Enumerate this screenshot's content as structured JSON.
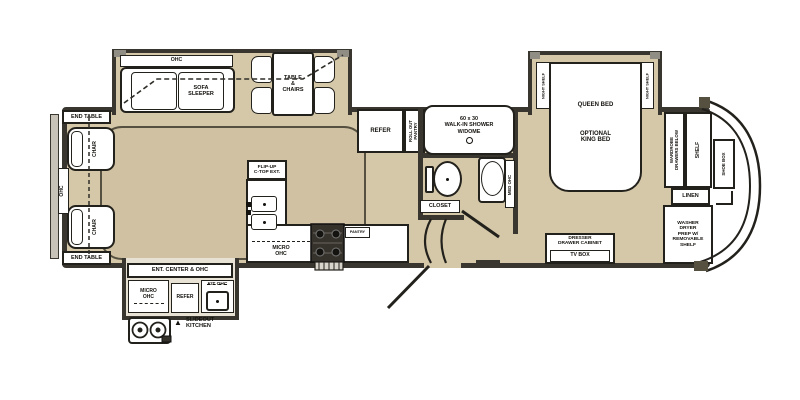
{
  "title": "fifth-wheel-rv-floor-plan",
  "colors": {
    "wall": "#39362f",
    "floor_tan": "#d5c8a9",
    "living_floor": "#cfc1a2",
    "fixture_white": "#ffffff",
    "slideout_fill": "#e7e2d4",
    "gray_cap": "#908d84"
  },
  "rear": {
    "end_table_top": "END TABLE",
    "end_table_bottom": "END TABLE",
    "chair_top": "CHAIR",
    "chair_bottom": "CHAIR",
    "ohc": "OHC"
  },
  "living_slideout": {
    "ohc": "OHC",
    "sofa_sleeper": "SOFA\nSLEEPER",
    "table_chairs": "TABLE\n&\nCHAIRS"
  },
  "kitchen": {
    "flip_up": "FLIP-UP\nC-TOP EXT.",
    "micro_ohc": "MICRO\nOHC",
    "pantry": "PANTRY",
    "refer": "REFER",
    "roll_out_pantry": "ROLL OUT\nPANTRY"
  },
  "bath": {
    "shower": "60 x 30\nWALK-IN SHOWER\nW/DOME",
    "med_ohc": "MED OHC",
    "closet": "CLOSET"
  },
  "bedroom": {
    "queen_bed": "QUEEN BED",
    "optional_king": "OPTIONAL\nKING BED",
    "night_shelf_left": "NIGHT SHELF",
    "night_shelf_right": "NIGHT SHELF",
    "dresser": "DRESSER\nDRAWER CABINET",
    "tv_box": "TV BOX"
  },
  "front": {
    "wardrobe": "WARDROBE\nDRAWERS BELOW",
    "shelf": "SHELF",
    "shoe_box": "SHOE BOX",
    "linen": "LINEN",
    "washer": "WASHER\nDRYER\nPREP W/\nREMOVABLE\nSHELF"
  },
  "slideout_kitchen": {
    "ent_center": "ENT. CENTER & OHC",
    "micro_ohc": "MICRO\nOHC",
    "refer": "REFER",
    "kit_ohc": "KIT OHC",
    "arrow": "▲",
    "label": "SLIDEOUT\nKITCHEN"
  }
}
